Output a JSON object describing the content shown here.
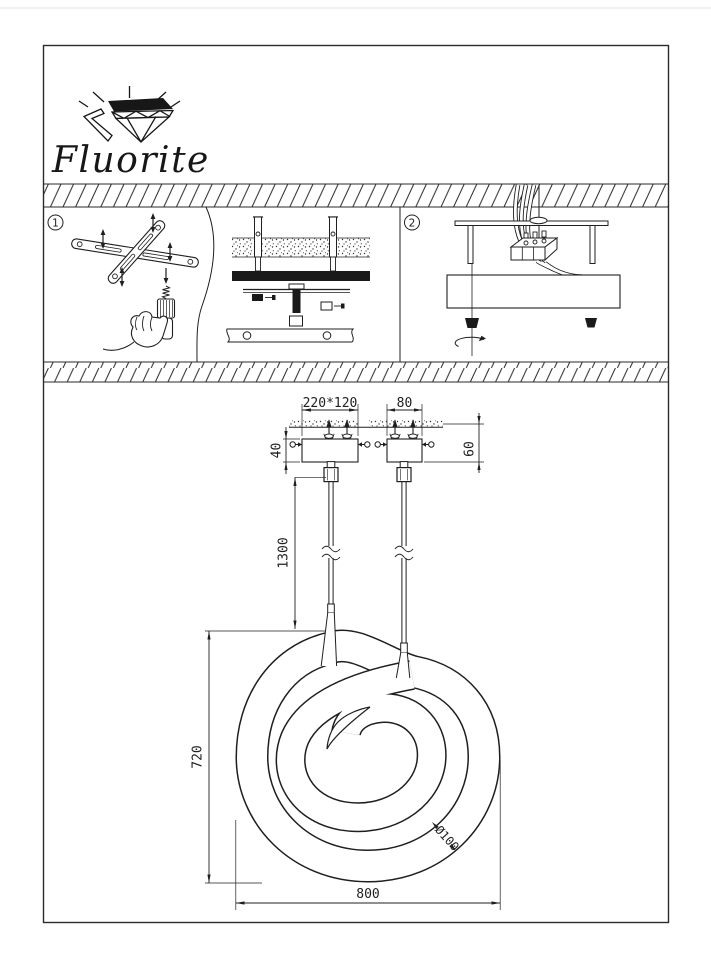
{
  "page": {
    "background": "#ffffff",
    "ink": "#1f1f1f",
    "border": "#2b2b2b"
  },
  "logo": {
    "brand": "Fluorite"
  },
  "steps": {
    "step1": "1",
    "step2": "2"
  },
  "dims": {
    "plate_large_width": "220*120",
    "plate_small_width": "80",
    "plate_large_height": "40",
    "plate_small_height": "60",
    "cord_length": "1300",
    "lamp_height": "720",
    "lamp_width": "800",
    "tube_diameter": "Ø100"
  }
}
